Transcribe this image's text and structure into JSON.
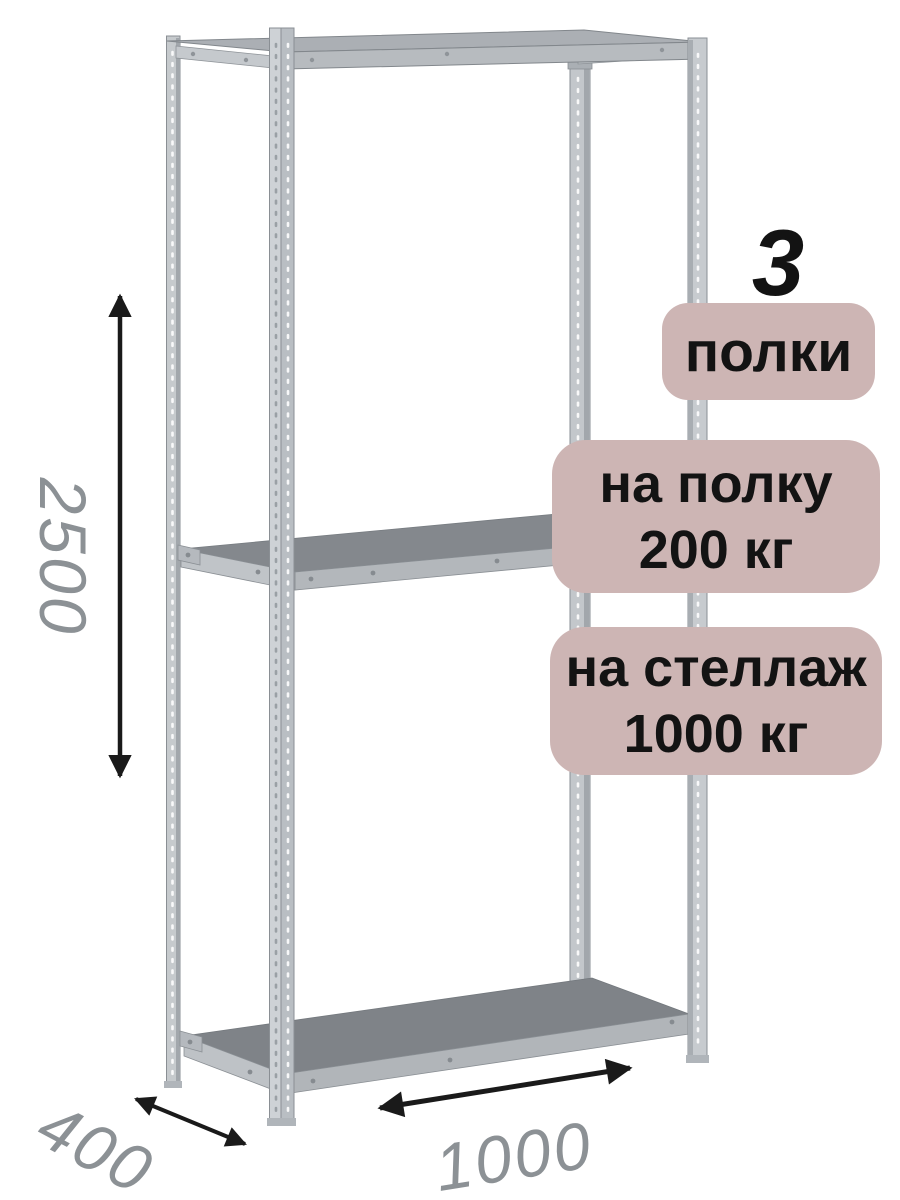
{
  "badges": {
    "count": {
      "number": "3",
      "label": "полки"
    },
    "shelf_load": {
      "line1": "на полку",
      "line2": "200 кг"
    },
    "rack_load": {
      "line1": "на стеллаж",
      "line2": "1000 кг"
    }
  },
  "dimensions": {
    "height": "2500",
    "depth": "400",
    "width": "1000"
  },
  "colors": {
    "badge_background": "#cdb5b4",
    "badge_text": "#131313",
    "dimension_text": "#8c9195",
    "arrow": "#1a1a1a",
    "metal_light": "#c9cdd1",
    "metal_medium": "#b6babe",
    "shelf_surface": "#83878c"
  }
}
